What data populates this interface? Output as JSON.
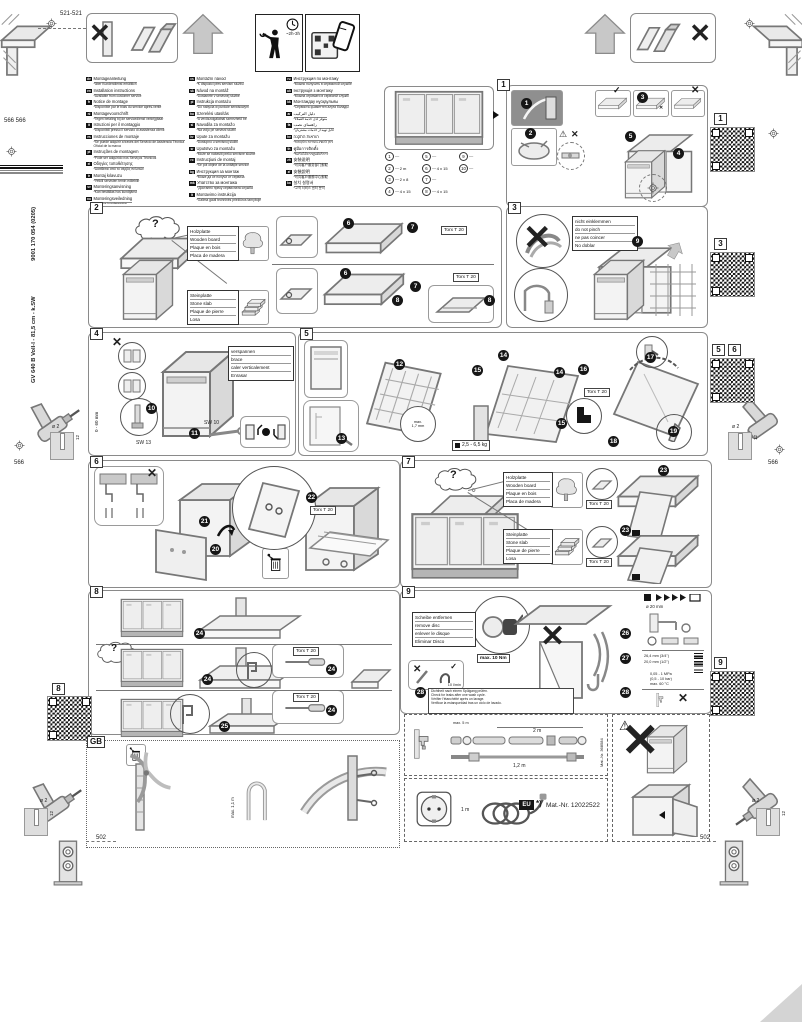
{
  "doc": {
    "dims": {
      "top_left": "521-521",
      "left_upper": "566 566",
      "side_left": "566",
      "side_right": "566",
      "bottom_left": "502",
      "bottom_right": "502"
    },
    "time_estimate": "~2h-3h",
    "spine": {
      "model": "GV 640 B Voll-I - 81,5 cm - k.SW",
      "order_no": "9001 170 054 (0205)"
    },
    "drill": {
      "dia": "ø 2",
      "depth": "12"
    },
    "gb_label": "GB"
  },
  "marks": {
    "ok": "✓",
    "no": "✕",
    "warn": "⚠",
    "question": "?"
  },
  "languages": {
    "col1": [
      {
        "code": "de",
        "title": "Montageanleitung",
        "note": "*über Kundendienst erhältlich"
      },
      {
        "code": "en",
        "title": "Installation instructions",
        "note": "*Available from customer service"
      },
      {
        "code": "fr",
        "title": "Notice de montage",
        "note": "*Disponible par le biais du service après-vente"
      },
      {
        "code": "nl",
        "title": "Montagevoorschrift",
        "note": "*Tegen betaling bij de servicedienst verkrijgbaar"
      },
      {
        "code": "it",
        "title": "Istruzioni per il montaggio",
        "note": "*Disponibili presso il servizio di assistenza clienti"
      },
      {
        "code": "es",
        "title": "Instrucciones de montaje",
        "note": "*Se puede adquirir a través del Servicio de Asistencia Técnica Oficial de la marca"
      },
      {
        "code": "pt",
        "title": "Instruções de montagem",
        "note": "*Pode ser adquirido nos Serviços Técnicos"
      },
      {
        "code": "el",
        "title": "Οδηγίες τοποθέτησης",
        "note": "*Διατίθεται από το σέρβις πελατών"
      },
      {
        "code": "tr",
        "title": "Montaj kılavuzu",
        "note": "*Yetkili servisten temin edilebilir"
      },
      {
        "code": "sv",
        "title": "Monteringsanvisning",
        "note": "*Kan beställas hos kundtjänst"
      },
      {
        "code": "no",
        "title": "Monteringsveiledning",
        "note": "*Fås hos kundeservice"
      },
      {
        "code": "da",
        "title": "Monteringsvejledning",
        "note": "*Kan fås hos kundeservice"
      },
      {
        "code": "fi",
        "title": "Asennusohje",
        "note": "*Saatavana huoltopalvelusta"
      }
    ],
    "col2": [
      {
        "code": "cs",
        "title": "Montážní návod",
        "note": "*K dispozici přes servisní službu"
      },
      {
        "code": "sk",
        "title": "Návod na montáž",
        "note": "*Dostanete v servisnej službe"
      },
      {
        "code": "pl",
        "title": "Instrukcja montażu",
        "note": "*Do nabycia w punkcie serwisowym"
      },
      {
        "code": "hu",
        "title": "Szerelési utasítás",
        "note": "*A vevőszolgálatnál szerezhető be"
      },
      {
        "code": "sl",
        "title": "Navodila za montažo",
        "note": "*Na voljo pri servisni službi"
      },
      {
        "code": "hr",
        "title": "Upute za montažu",
        "note": "*Dostupno u servisnoj službi"
      },
      {
        "code": "sr",
        "title": "Uputstvo za montažu",
        "note": "*Može se nabaviti preko servisne službe"
      },
      {
        "code": "ro",
        "title": "Instrucţiuni de montaj",
        "note": "*Se pot obţine de la unităţile service"
      },
      {
        "code": "bg",
        "title": "Инструкция за монтаж",
        "note": "*Може да се получи от сервиза"
      },
      {
        "code": "mk",
        "title": "Упатство за монтажа",
        "note": "*Достапно преку сервисната служба"
      },
      {
        "code": "lt",
        "title": "Montavimo instrukcija",
        "note": "*Galima gauti techninės priežiūros tarnyboje"
      },
      {
        "code": "lv",
        "title": "Montāžas instrukcija",
        "note": "*Pieejama klientu servisā"
      },
      {
        "code": "et",
        "title": "Paigaldusjuhend",
        "note": "*Saadaval klienditeeninduses"
      }
    ],
    "col3": [
      {
        "code": "ru",
        "title": "Инструкция по монтажу",
        "note": "*Можно получить в сервисной службе"
      },
      {
        "code": "uk",
        "title": "Інструкція з монтажу",
        "note": "*Можна отримати в сервісній службі"
      },
      {
        "code": "kk",
        "title": "Монтаждау нұсқаулығы",
        "note": "*Сервистік қызметтен алуға болады"
      },
      {
        "code": "ar",
        "title": "دليل التركيب",
        "note": "*متوفر لدى خدمة العملاء"
      },
      {
        "code": "fa",
        "title": "راهنمای نصب",
        "note": "*قابل تهیه از خدمات مشتریان"
      },
      {
        "code": "he",
        "title": "הוראות התקנה",
        "note": "*ניתן להשיג בשירות הלקוחות"
      },
      {
        "code": "th",
        "title": "คู่มือการติดตั้ง",
        "note": "*ขอรับได้จากศูนย์บริการ"
      },
      {
        "code": "zh",
        "title": "安装说明",
        "note": "*可向客户服务部门索取"
      },
      {
        "code": "zf",
        "title": "安裝說明",
        "note": "*可向客戶服務中心索取"
      },
      {
        "code": "ko",
        "title": "설치 설명서",
        "note": "*고객 서비스 센터 문의"
      }
    ]
  },
  "sections": {
    "s1": {
      "num": "1",
      "steps": [
        "1",
        "2",
        "3",
        "4",
        "5"
      ],
      "parts": [
        {
          "n": "1",
          "size": ""
        },
        {
          "n": "2",
          "size": "2 m"
        },
        {
          "n": "3",
          "size": "2 x 8"
        },
        {
          "n": "4",
          "size": "4 x 15"
        },
        {
          "n": "5",
          "size": ""
        },
        {
          "n": "6",
          "size": "4 x 15"
        },
        {
          "n": "7",
          "size": ""
        },
        {
          "n": "8",
          "size": "4 x 15"
        },
        {
          "n": "9",
          "size": ""
        },
        {
          "n": "10",
          "size": ""
        }
      ]
    },
    "s2": {
      "num": "2",
      "steps": [
        "6",
        "7",
        "6",
        "7",
        "8",
        "8"
      ],
      "torx": "Torx T 20",
      "wood": [
        "Holzplatte",
        "Wooden board",
        "Plaque en bois",
        "Placa de madera"
      ],
      "stone": [
        "Steinplatte",
        "Stone slab",
        "Plaque de pierre",
        "Losa"
      ]
    },
    "s3": {
      "num": "3",
      "steps": [
        "9"
      ],
      "warning": [
        "nicht einklemmen",
        "do not pinch",
        "ne pas coincer",
        "No doblar"
      ]
    },
    "s4": {
      "num": "4",
      "steps": [
        "10",
        "11"
      ],
      "brace": [
        "verspannen",
        "brace",
        "caler verticalement",
        "Enrasar"
      ],
      "sw13": "SW 13",
      "sw10": "SW 10",
      "range": "0 - 60 mm"
    },
    "s5": {
      "num": "5",
      "steps": [
        "12",
        "13",
        "14",
        "15",
        "14",
        "15",
        "16",
        "17",
        "18",
        "19"
      ],
      "gap_line1": "max.",
      "gap_line2": "1,7 mm",
      "weight": "2,5 - 6,5 kg",
      "torx": "Torx T 20"
    },
    "s6": {
      "num": "6",
      "steps": [
        "20",
        "21",
        "22"
      ],
      "torx": "Torx T 20"
    },
    "s7": {
      "num": "7",
      "steps": [
        "23",
        "23"
      ],
      "torx": "Torx T 20",
      "wood": [
        "Holzplatte",
        "Wooden board",
        "Plaque en bois",
        "Placa de madera"
      ],
      "stone": [
        "Steinplatte",
        "Stone slab",
        "Plaque de pierre",
        "Losa"
      ]
    },
    "s8": {
      "num": "8",
      "steps": [
        "24",
        "24",
        "24",
        "24",
        "25"
      ],
      "torx": "Torx T 20"
    },
    "s9": {
      "num": "9",
      "steps": [
        "26",
        "27",
        "28",
        "28"
      ],
      "disc": [
        "Scheibe entfernen",
        "remove disc",
        "enlever le disque",
        "Eliminar Disco"
      ],
      "torque": "max. 10 Nm",
      "flow": "10 l/min",
      "leak": [
        "Dichtheit nach einem Spülgang prüfen.",
        "Check for leaks after one wash cycle.",
        "Vérifier l'étanchéité après un lavage.",
        "Verificar la estanqueidad tras un ciclo de lavado."
      ],
      "water": {
        "dia": "ø 20 mm",
        "thread_big": "26,4 mm (3/4\")",
        "thread_small": "20,0 mm (1/2\")",
        "pressure": "0,05 - 1 MPa",
        "pressure2": "(0,5 - 10 bar)",
        "temp": "max. 60 °C"
      }
    }
  },
  "qr_labels": {
    "q1": "1",
    "q3": "3",
    "q5": "5",
    "q6": "6",
    "q8": "8",
    "q9": "9"
  },
  "bottom": {
    "hose": {
      "len_top": "2 m",
      "len_bottom": "1,2 m",
      "len_max": "max. 5 m",
      "mat_no": "Mat.-Nr. 368584"
    },
    "power": {
      "len": "1 m",
      "region": "EU",
      "note": "*)",
      "mat_no": "Mat.-Nr. 12022522"
    },
    "gb": {
      "hose_height": "max. 1,1 m"
    }
  }
}
